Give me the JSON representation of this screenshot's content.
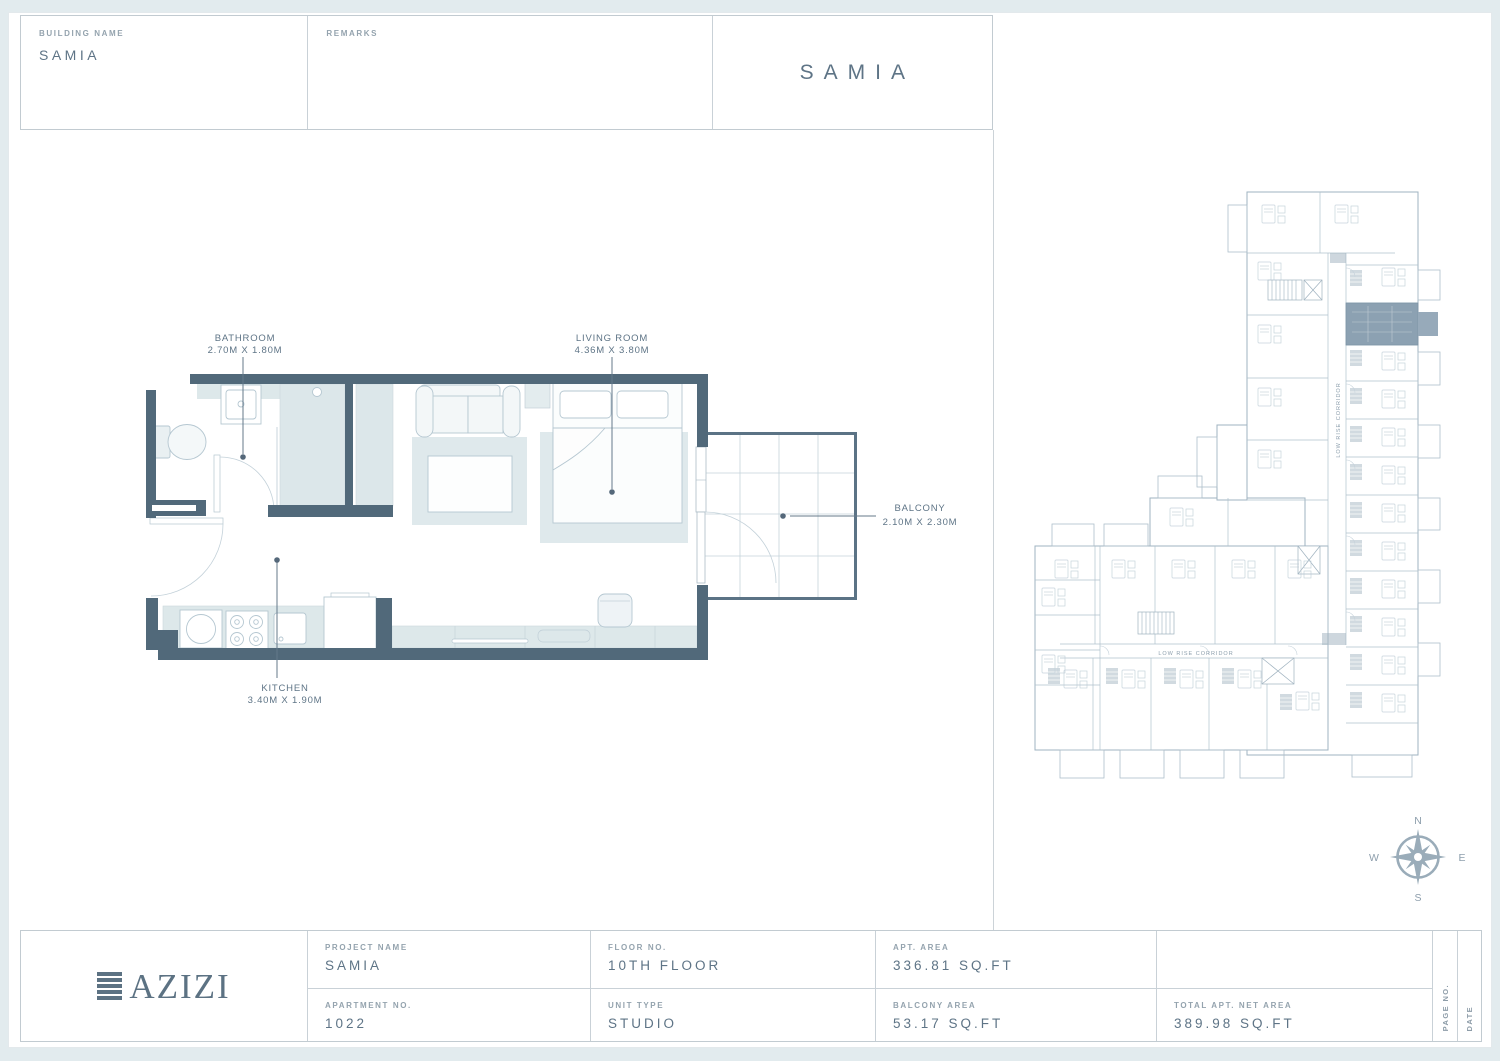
{
  "header": {
    "building_name_label": "BUILDING NAME",
    "building_name_value": "SAMIA",
    "remarks_label": "REMARKS",
    "sheet_title": "SAMIA"
  },
  "plan": {
    "rooms": [
      {
        "label": "BATHROOM",
        "dims": "2.70M X 1.80M"
      },
      {
        "label": "LIVING ROOM",
        "dims": "4.36M X 3.80M"
      },
      {
        "label": "KITCHEN",
        "dims": "3.40M X 1.90M"
      },
      {
        "label": "BALCONY",
        "dims": "2.10M X 2.30M"
      }
    ]
  },
  "overview": {
    "corridor_label_vertical": "LOW RISE CORRIDOR",
    "corridor_label_horizontal": "LOW RISE CORRIDOR"
  },
  "compass": {
    "north": "N",
    "south": "S",
    "east": "E",
    "west": "W"
  },
  "footer": {
    "logo_text": "AZIZI",
    "project_name_label": "PROJECT NAME",
    "project_name_value": "SAMIA",
    "apartment_no_label": "APARTMENT NO.",
    "apartment_no_value": "1022",
    "floor_no_label": "FLOOR NO.",
    "floor_no_value": "10TH FLOOR",
    "unit_type_label": "UNIT TYPE",
    "unit_type_value": "STUDIO",
    "apt_area_label": "APT. AREA",
    "apt_area_value": "336.81 SQ.FT",
    "balcony_area_label": "BALCONY AREA",
    "balcony_area_value": "53.17 SQ.FT",
    "total_area_label": "TOTAL APT. NET AREA",
    "total_area_value": "389.98 SQ.FT",
    "page_no_label": "PAGE NO.",
    "date_label": "DATE"
  },
  "colors": {
    "wall": "#51697a",
    "room_fill": "#dce7ea",
    "drawing_line": "#b5c7d1",
    "text_primary": "#5e7486",
    "text_muted": "#94a3ae",
    "unit_highlight": "#8ca1b2",
    "page_margin": "#e2ebee"
  }
}
